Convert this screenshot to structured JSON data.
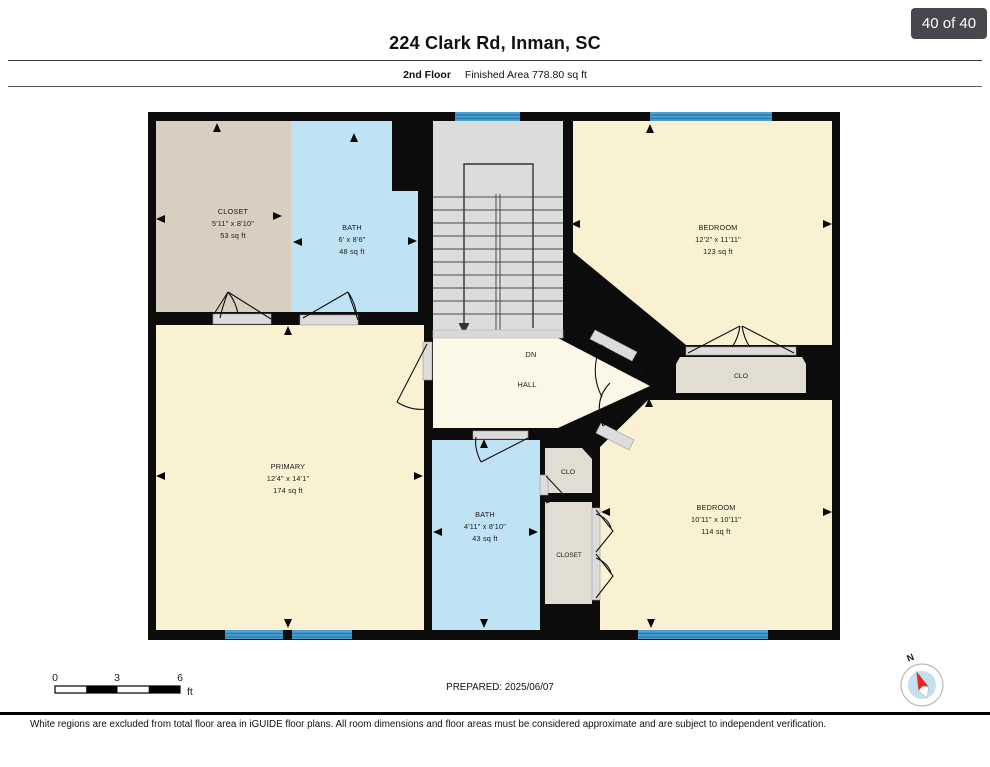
{
  "page": {
    "badge": "40 of 40",
    "title": "224 Clark Rd, Inman, SC",
    "floor_label": "2nd Floor",
    "area_label": "Finished Area 778.80 sq ft",
    "prepared": "PREPARED: 2025/06/07",
    "disclaimer": "White regions are excluded from total floor area in iGUIDE floor plans. All room dimensions and floor areas must be considered approximate and are subject to independent verification.",
    "compass_north": "N"
  },
  "scale_bar": {
    "tick0": "0",
    "tick1": "3",
    "tick2": "6",
    "unit": "ft"
  },
  "plan": {
    "floor": "2nd Floor",
    "stair_direction": "DN",
    "rooms": [
      {
        "id": "closet-upper",
        "name": "CLOSET",
        "dims": "5'11\" x 8'10\"",
        "area": "53 sq ft"
      },
      {
        "id": "bath-upper",
        "name": "BATH",
        "dims": "6' x 8'6\"",
        "area": "48 sq ft"
      },
      {
        "id": "bedroom-upper",
        "name": "BEDROOM",
        "dims": "12'2\" x 11'11\"",
        "area": "123 sq ft"
      },
      {
        "id": "hall",
        "name": "HALL"
      },
      {
        "id": "primary",
        "name": "PRIMARY",
        "dims": "12'4\" x 14'1\"",
        "area": "174 sq ft"
      },
      {
        "id": "bath-lower",
        "name": "BATH",
        "dims": "4'11\" x 8'10\"",
        "area": "43 sq ft"
      },
      {
        "id": "clo-hall",
        "name": "CLO"
      },
      {
        "id": "closet-lower",
        "name": "CLOSET"
      },
      {
        "id": "clo-bedroom",
        "name": "CLO"
      },
      {
        "id": "bedroom-lower",
        "name": "BEDROOM",
        "dims": "10'11\" x 10'11\"",
        "area": "114 sq ft"
      }
    ],
    "colors": {
      "wall": "#0c0c0c",
      "room_cream": "#faf0d2",
      "hall_cream": "#fcf8e8",
      "closet_tan": "#d8cfc0",
      "closet_greige": "#e2ddd2",
      "bath_blue": "#bfe2f5",
      "stairs_gray": "#dcdcdc",
      "window_blue": "#4aa0d2"
    }
  }
}
